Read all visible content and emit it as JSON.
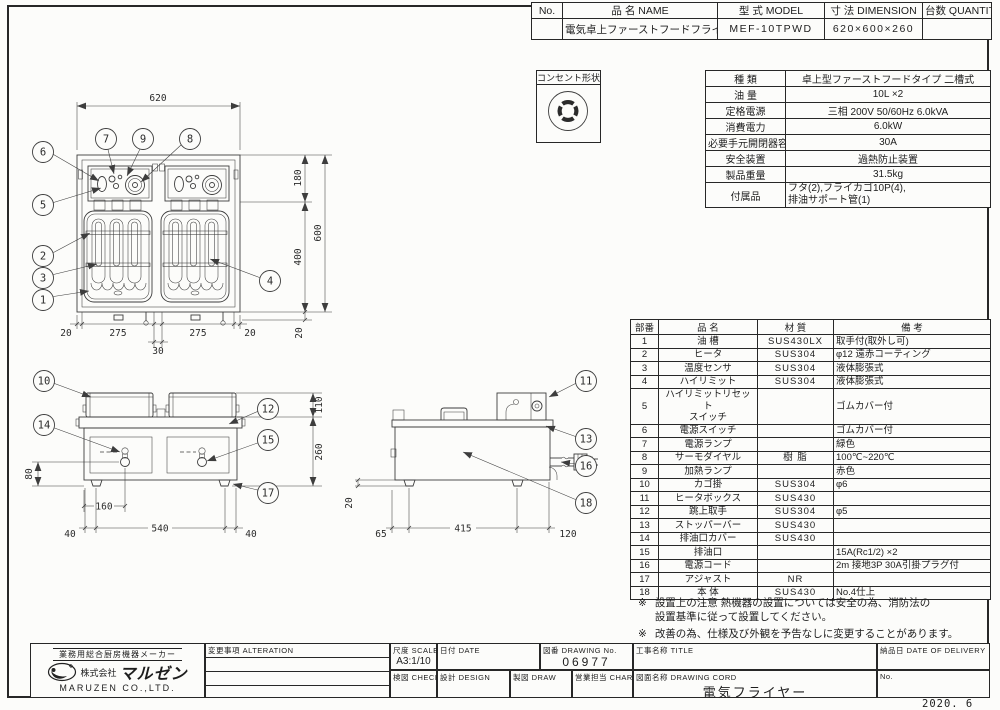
{
  "sheet": {
    "issued": "2020. 6"
  },
  "model_table": {
    "headers": {
      "no": "No.",
      "name": "品 名 NAME",
      "model": "型 式 MODEL",
      "dimension": "寸 法 DIMENSION",
      "quantity": "台数 QUANTITY"
    },
    "row": {
      "no": "",
      "name": "電気卓上ファーストフードフライヤー",
      "model": "MEF-10TPWD",
      "dimension": "620×600×260",
      "quantity": ""
    }
  },
  "outlet": {
    "label": "コンセント形状"
  },
  "spec_table": {
    "rows": [
      {
        "label": "種 類",
        "value": "卓上型ファーストフードタイプ 二槽式"
      },
      {
        "label": "油 量",
        "value": "10L ×2"
      },
      {
        "label": "定格電源",
        "value": "三相 200V 50/60Hz 6.0kVA"
      },
      {
        "label": "消費電力",
        "value": "6.0kW"
      },
      {
        "label": "必要手元開閉器容量",
        "value": "30A"
      },
      {
        "label": "安全装置",
        "value": "過熱防止装置"
      },
      {
        "label": "製品重量",
        "value": "31.5kg"
      },
      {
        "label": "付属品",
        "value": "フタ(2),フライカゴ10P(4),\n排油サポート管(1)"
      }
    ]
  },
  "parts_table": {
    "headers": {
      "no": "部番",
      "name": "品 名",
      "material": "材 質",
      "note": "備 考"
    },
    "rows": [
      {
        "no": "1",
        "name": "油 槽",
        "material": "SUS430LX",
        "note": "取手付(取外し可)"
      },
      {
        "no": "2",
        "name": "ヒータ",
        "material": "SUS304",
        "note": "φ12 遠赤コーティング"
      },
      {
        "no": "3",
        "name": "温度センサ",
        "material": "SUS304",
        "note": "液体膨張式"
      },
      {
        "no": "4",
        "name": "ハイリミット",
        "material": "SUS304",
        "note": "液体膨張式"
      },
      {
        "no": "5",
        "name": "ハイリミットリセット\nスイッチ",
        "material": "",
        "note": "ゴムカバー付"
      },
      {
        "no": "6",
        "name": "電源スイッチ",
        "material": "",
        "note": "ゴムカバー付"
      },
      {
        "no": "7",
        "name": "電源ランプ",
        "material": "",
        "note": "緑色"
      },
      {
        "no": "8",
        "name": "サーモダイヤル",
        "material": "樹 脂",
        "note": "100℃~220℃"
      },
      {
        "no": "9",
        "name": "加熱ランプ",
        "material": "",
        "note": "赤色"
      },
      {
        "no": "10",
        "name": "カゴ掛",
        "material": "SUS304",
        "note": "φ6"
      },
      {
        "no": "11",
        "name": "ヒータボックス",
        "material": "SUS430",
        "note": ""
      },
      {
        "no": "12",
        "name": "跳上取手",
        "material": "SUS304",
        "note": "φ5"
      },
      {
        "no": "13",
        "name": "ストッパーバー",
        "material": "SUS430",
        "note": ""
      },
      {
        "no": "14",
        "name": "排油口カバー",
        "material": "SUS430",
        "note": ""
      },
      {
        "no": "15",
        "name": "排油口",
        "material": "",
        "note": "15A(Rc1/2) ×2"
      },
      {
        "no": "16",
        "name": "電源コード",
        "material": "",
        "note": "2m 接地3P 30A引掛プラグ付"
      },
      {
        "no": "17",
        "name": "アジャスト",
        "material": "NR",
        "note": ""
      },
      {
        "no": "18",
        "name": "本 体",
        "material": "SUS430",
        "note": "No.4仕上"
      }
    ]
  },
  "notes": [
    {
      "mark": "※",
      "text": "設置上の注意 熱機器の設置については安全の為、消防法の\n設置基準に従って設置してください。"
    },
    {
      "mark": "※",
      "text": "改善の為、仕様及び外観を予告なしに変更することがあります。"
    }
  ],
  "title_block": {
    "company": {
      "tagline": "業務用総合厨房機器メーカー",
      "prefix": "株式会社",
      "name": "マルゼン",
      "en": "MARUZEN CO.,LTD."
    },
    "alteration": "変更事項 ALTERATION",
    "scale_label": "尺度 SCALE",
    "scale": "A3:1/10",
    "date_label": "日付 DATE",
    "dno_label": "図番 DRAWING No.",
    "dno": "06977",
    "title_label": "工事名称 TITLE",
    "check_label": "検図 CHECK",
    "design_label": "設計 DESIGN",
    "draw_label": "製図 DRAW",
    "charge_label": "営業担当 CHARGE",
    "dname_label": "図面名称 DRAWING CORD",
    "dname": "電気フライヤー",
    "delivery_label": "納品日 DATE OF DELIVERY",
    "no_label": "No."
  },
  "views": {
    "plan": {
      "dims": [
        "620",
        "180",
        "400",
        "600",
        "20",
        "275",
        "275",
        "20",
        "30",
        "20"
      ],
      "callouts": [
        "1",
        "2",
        "3",
        "4",
        "5",
        "6",
        "7",
        "8",
        "9"
      ]
    },
    "front": {
      "dims": [
        "110",
        "260",
        "80",
        "160",
        "40",
        "540",
        "40"
      ],
      "callouts": [
        "10",
        "12",
        "14",
        "15",
        "17"
      ]
    },
    "side": {
      "dims": [
        "20",
        "65",
        "415",
        "120"
      ],
      "callouts": [
        "11",
        "13",
        "16",
        "18"
      ]
    }
  }
}
